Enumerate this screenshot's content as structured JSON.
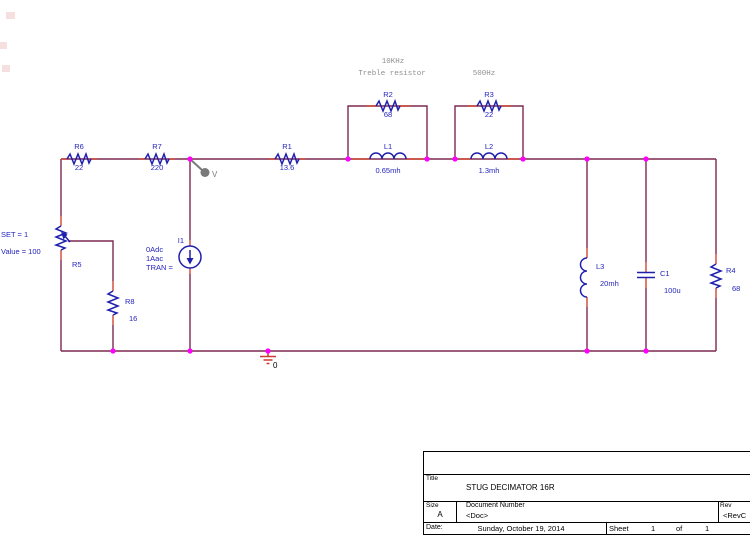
{
  "colors": {
    "wire": "#7d2950",
    "pin": "#cf4733",
    "sym": "#1f1fae",
    "lbl": "#2424bd",
    "dot": "#ff00ff",
    "ann": "#8f8f8f",
    "probe": "#7a7a7a",
    "gnd": "#cc3b33"
  },
  "schematic": {
    "components": {
      "r1": {
        "ref": "R1",
        "value": "13.6"
      },
      "r2": {
        "ref": "R2",
        "value": "68"
      },
      "r3": {
        "ref": "R3",
        "value": "22"
      },
      "r4": {
        "ref": "R4",
        "value": "68"
      },
      "r5": {
        "ref": "R5",
        "set": "SET = 1",
        "value": "Value = 100"
      },
      "r6": {
        "ref": "R6",
        "value": "22"
      },
      "r7": {
        "ref": "R7",
        "value": "220"
      },
      "r8": {
        "ref": "R8",
        "value": "16"
      },
      "l1": {
        "ref": "L1",
        "value": "0.65mh"
      },
      "l2": {
        "ref": "L2",
        "value": "1.3mh"
      },
      "l3": {
        "ref": "L3",
        "value": "20mh"
      },
      "c1": {
        "ref": "C1",
        "value": "100u"
      },
      "i1": {
        "ref": "I1",
        "line1": "0Adc",
        "line2": "1Aac",
        "line3": "TRAN ="
      }
    },
    "annotations": {
      "treble_freq": "10KHz",
      "treble_label": "Treble resistor",
      "mid_freq": "500Hz",
      "probe_label": "V",
      "ground_label": "0"
    }
  },
  "titleblock": {
    "title_label": "Title",
    "title": "STUG DECIMATOR 16R",
    "size_label": "Size",
    "size": "A",
    "doc_label": "Document Number",
    "doc": "<Doc>",
    "rev_label": "Rev",
    "rev": "<RevC",
    "date_label": "Date:",
    "date": "Sunday, October 19, 2014",
    "sheet_label": "Sheet",
    "sheet_num": "1",
    "of_label": "of",
    "sheet_total": "1"
  }
}
